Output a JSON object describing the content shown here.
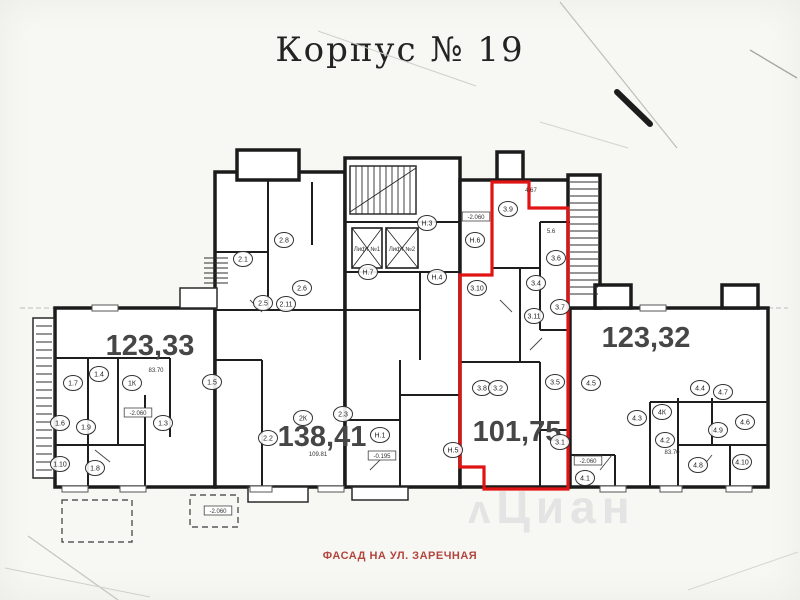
{
  "page": {
    "title": "Корпус № 19",
    "caption": "ФАСАД НА УЛ. ЗАРЕЧНАЯ",
    "watermark": "Циан",
    "watermark_mark": "ʌ"
  },
  "colors": {
    "highlight_red": "#e01414",
    "caption_red": "#b2453e",
    "wall_black": "#1b1b1b"
  },
  "plan": {
    "apartments": [
      {
        "id": "apt-1",
        "area_label": "123,33",
        "x": 150,
        "y": 355,
        "highlighted": false
      },
      {
        "id": "apt-2",
        "area_label": "138,41",
        "x": 322,
        "y": 446,
        "highlighted": false
      },
      {
        "id": "apt-3",
        "area_label": "101,75",
        "x": 517,
        "y": 441,
        "highlighted": true
      },
      {
        "id": "apt-4",
        "area_label": "123,32",
        "x": 646,
        "y": 347,
        "highlighted": false
      }
    ],
    "rooms": [
      {
        "label": "1.7",
        "x": 73,
        "y": 383
      },
      {
        "label": "1.4",
        "x": 99,
        "y": 374
      },
      {
        "label": "1К",
        "x": 132,
        "y": 383
      },
      {
        "label": "1.5",
        "x": 212,
        "y": 382
      },
      {
        "label": "1.6",
        "x": 60,
        "y": 423
      },
      {
        "label": "1.9",
        "x": 86,
        "y": 427
      },
      {
        "label": "1.3",
        "x": 163,
        "y": 423
      },
      {
        "label": "1.10",
        "x": 60,
        "y": 464
      },
      {
        "label": "1.8",
        "x": 95,
        "y": 468
      },
      {
        "label": "2.8",
        "x": 284,
        "y": 240
      },
      {
        "label": "2.1",
        "x": 243,
        "y": 259
      },
      {
        "label": "2.6",
        "x": 302,
        "y": 288
      },
      {
        "label": "2.5",
        "x": 263,
        "y": 303
      },
      {
        "label": "2.11",
        "x": 286,
        "y": 304
      },
      {
        "label": "2К",
        "x": 303,
        "y": 418
      },
      {
        "label": "2.3",
        "x": 343,
        "y": 414
      },
      {
        "label": "2.2",
        "x": 268,
        "y": 438
      },
      {
        "label": "Н.3",
        "x": 427,
        "y": 223
      },
      {
        "label": "Н.6",
        "x": 475,
        "y": 240
      },
      {
        "label": "Н.7",
        "x": 368,
        "y": 272
      },
      {
        "label": "Н.4",
        "x": 437,
        "y": 277
      },
      {
        "label": "Н.1",
        "x": 380,
        "y": 435
      },
      {
        "label": "Н.5",
        "x": 453,
        "y": 450
      },
      {
        "label": "3.9",
        "x": 508,
        "y": 209
      },
      {
        "label": "3.6",
        "x": 556,
        "y": 258
      },
      {
        "label": "3.4",
        "x": 536,
        "y": 283
      },
      {
        "label": "3.10",
        "x": 477,
        "y": 288
      },
      {
        "label": "3.7",
        "x": 560,
        "y": 307
      },
      {
        "label": "3.11",
        "x": 534,
        "y": 316
      },
      {
        "label": "3.5",
        "x": 555,
        "y": 382
      },
      {
        "label": "3.8",
        "x": 482,
        "y": 388
      },
      {
        "label": "3.2",
        "x": 498,
        "y": 388
      },
      {
        "label": "3.1",
        "x": 560,
        "y": 442
      },
      {
        "label": "4.5",
        "x": 591,
        "y": 383
      },
      {
        "label": "4.4",
        "x": 700,
        "y": 388
      },
      {
        "label": "4.7",
        "x": 723,
        "y": 392
      },
      {
        "label": "4.3",
        "x": 637,
        "y": 418
      },
      {
        "label": "4К",
        "x": 662,
        "y": 412
      },
      {
        "label": "4.2",
        "x": 665,
        "y": 440
      },
      {
        "label": "4.9",
        "x": 718,
        "y": 430
      },
      {
        "label": "4.6",
        "x": 745,
        "y": 422
      },
      {
        "label": "4.8",
        "x": 698,
        "y": 465
      },
      {
        "label": "4.10",
        "x": 742,
        "y": 462
      },
      {
        "label": "4.1",
        "x": 585,
        "y": 478
      }
    ],
    "marks": [
      {
        "text": "-2.060",
        "x": 138,
        "y": 414,
        "boxed": true
      },
      {
        "text": "-2.060",
        "x": 218,
        "y": 512,
        "boxed": true
      },
      {
        "text": "-0.195",
        "x": 382,
        "y": 457,
        "boxed": true
      },
      {
        "text": "-2.060",
        "x": 476,
        "y": 218,
        "boxed": true
      },
      {
        "text": "-2.060",
        "x": 588,
        "y": 462,
        "boxed": true
      },
      {
        "text": "83.70",
        "x": 156,
        "y": 371,
        "boxed": false
      },
      {
        "text": "83.70",
        "x": 672,
        "y": 453,
        "boxed": false
      },
      {
        "text": "109.81",
        "x": 318,
        "y": 455,
        "boxed": false
      },
      {
        "text": "4.67",
        "x": 531,
        "y": 191,
        "boxed": false
      },
      {
        "text": "5.6",
        "x": 551,
        "y": 232,
        "boxed": false
      },
      {
        "text": "Лифт №1",
        "x": 367,
        "y": 250,
        "boxed": false
      },
      {
        "text": "Лифт №2",
        "x": 402,
        "y": 250,
        "boxed": false
      }
    ]
  }
}
